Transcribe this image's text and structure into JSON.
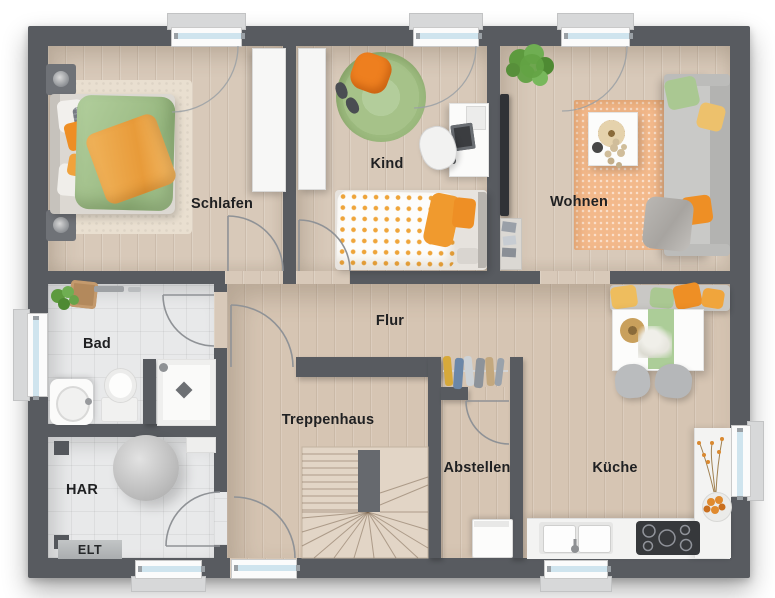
{
  "floor_plan": {
    "room_labels": {
      "schlafen": "Schlafen",
      "kind": "Kind",
      "wohnen": "Wohnen",
      "flur": "Flur",
      "bad": "Bad",
      "treppenhaus": "Treppenhaus",
      "abstellen": "Abstellen",
      "kueche": "Küche",
      "har": "HAR",
      "elt": "ELT"
    },
    "palette": {
      "wall": "#585b60",
      "wood_floor": "#d8c9b9",
      "tile_floor": "#e8e9ea",
      "stair_wood": "#e2d5c6",
      "accent_orange": "#ee8f25",
      "accent_green": "#a9c791",
      "window_glass": "#cfe4ee",
      "label_text": "#1f2022"
    }
  }
}
